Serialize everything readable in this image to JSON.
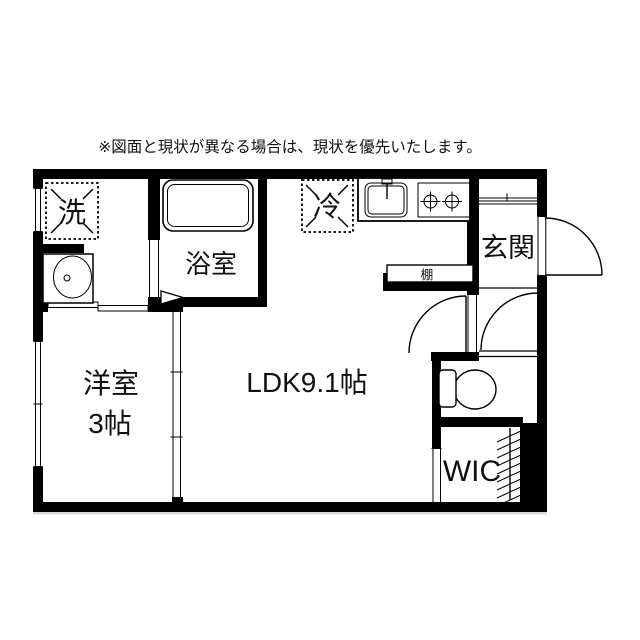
{
  "disclaimer": "※図面と現状が異なる場合は、現状を優先いたします。",
  "labels": {
    "ldk": "LDK9.1帖",
    "western_room_line1": "洋室",
    "western_room_line2": "3帖",
    "bathroom": "浴室",
    "entrance": "玄関",
    "wic": "WIC",
    "shelf": "棚",
    "washing_machine": "洗",
    "refrigerator": "冷"
  },
  "colors": {
    "wall": "#000000",
    "text": "#111111",
    "background": "#ffffff"
  }
}
